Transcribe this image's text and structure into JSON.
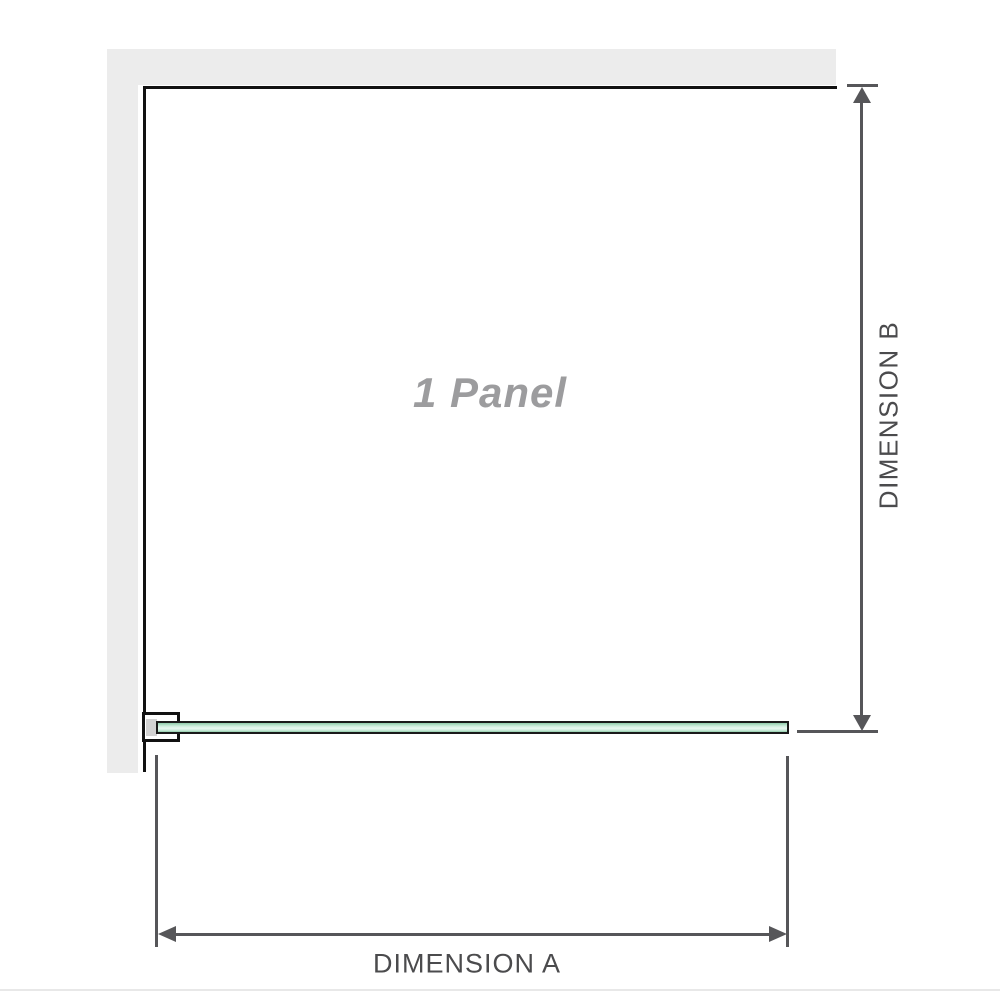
{
  "diagram": {
    "panel_label": "1 Panel",
    "dimension_a_label": "DIMENSION A",
    "dimension_b_label": "DIMENSION B"
  },
  "colors": {
    "background": "#ffffff",
    "wall": "#ececec",
    "outline": "#111111",
    "dimension": "#565659",
    "dimension_text": "#4b4b4d",
    "panel_label_text": "#9c9c9e",
    "glass_border": "#1a1a1a",
    "glass_green_dark": "#8fcbaa",
    "glass_green_mid": "#c9ebd9",
    "glass_green_light": "#e9f8f1",
    "bracket_fill": "#ffffff",
    "bracket_inner": "#d2d2d2",
    "baseline": "#e8e8e8"
  }
}
